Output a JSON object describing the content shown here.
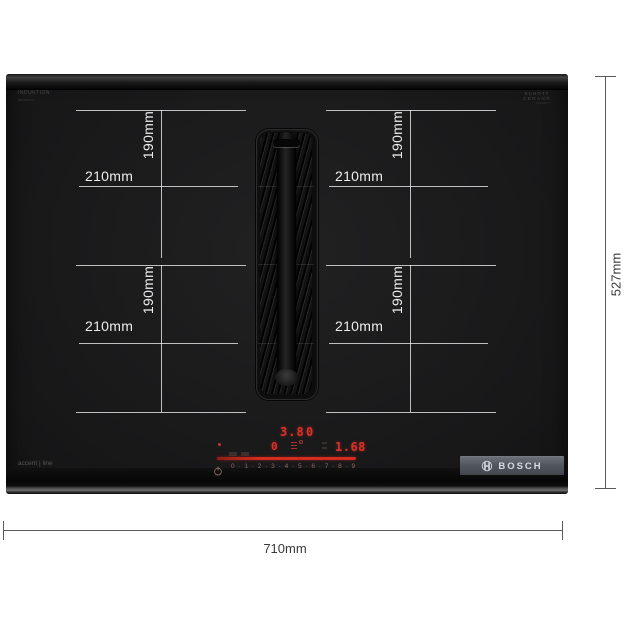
{
  "product": {
    "brand": "BOSCH",
    "glass_print_top_left": [
      "INDUKTION",
      "induction"
    ],
    "glass_print_top_right": [
      "SCHOTT",
      "CERAN®",
      "Miradur™"
    ],
    "series_label": "accent | line"
  },
  "control_panel": {
    "display_row1_left": "3.8",
    "display_row1_right": "0",
    "display_row2_left": "0",
    "display_row2_right": "1.68",
    "slider_scale": "0 · 1 · 2 · 3 · 4 · 5 · 6 · 7 · 8 · 9",
    "led_color": "#d93229"
  },
  "dimensions": {
    "overall_width": "710mm",
    "overall_depth": "527mm",
    "zones": [
      {
        "position": "rear-left",
        "width": "210mm",
        "depth": "190mm"
      },
      {
        "position": "rear-right",
        "width": "210mm",
        "depth": "190mm"
      },
      {
        "position": "front-left",
        "width": "210mm",
        "depth": "190mm"
      },
      {
        "position": "front-right",
        "width": "210mm",
        "depth": "190mm"
      }
    ]
  },
  "colors": {
    "glass_black": "#1a1a1b",
    "zone_line": "#ffffff",
    "led_red": "#d93229",
    "badge_gray": "#51575d",
    "dimension_line": "#5a5a5a"
  }
}
